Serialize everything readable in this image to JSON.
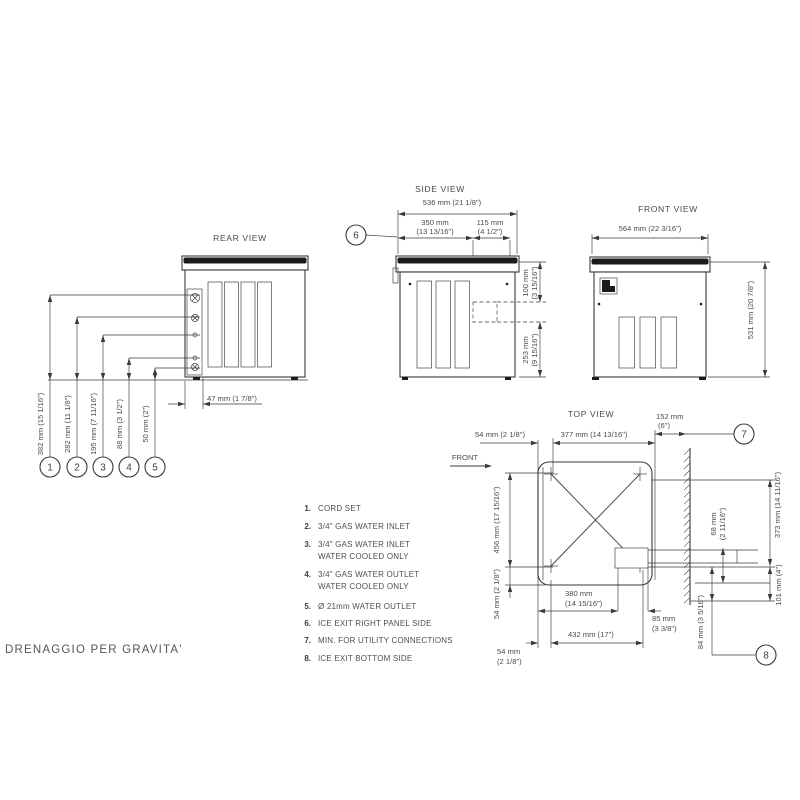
{
  "footer_note": "DRENAGGIO PER GRAVITA'",
  "views": {
    "rear": {
      "label": "REAR VIEW",
      "dim_382": "382 mm (15 1/16\")",
      "dim_282": "282 mm (11 1/8\")",
      "dim_195": "195 mm (7 11/16\")",
      "dim_88": "88 mm (3 1/2\")",
      "dim_50": "50 mm (2\")",
      "dim_47": "47 mm (1 7/8\")",
      "c1": "1",
      "c2": "2",
      "c3": "3",
      "c4": "4",
      "c5": "5"
    },
    "side": {
      "label": "SIDE VIEW",
      "dim_536": "536 mm (21 1/8\")",
      "dim_350_l1": "350 mm",
      "dim_350_l2": "(13 13/16\")",
      "dim_115_l1": "115 mm",
      "dim_115_l2": "(4 1/2\")",
      "dim_100_l1": "100 mm",
      "dim_100_l2": "(3 15/16\")",
      "dim_253_l1": "253 mm",
      "dim_253_l2": "(9 15/16\")",
      "c6": "6"
    },
    "front": {
      "label": "FRONT VIEW",
      "dim_564": "564 mm (22 3/16\")",
      "dim_531": "531 mm (20 7/8\")"
    },
    "top": {
      "label": "TOP VIEW",
      "front_label": "FRONT",
      "dim_54_top": "54 mm  (2 1/8\")",
      "dim_377": "377 mm  (14 13/16\")",
      "dim_152_l1": "152 mm",
      "dim_152_l2": "(6\")",
      "dim_456": "456 mm (17 15/16\")",
      "dim_54_left": "54 mm (2 1/8\")",
      "dim_380_l1": "380 mm",
      "dim_380_l2": "(14 15/16\")",
      "dim_432": "432 mm  (17\")",
      "dim_85_l1": "85 mm",
      "dim_85_l2": "(3 3/8\")",
      "dim_54_bot_l1": "54 mm",
      "dim_54_bot_l2": "(2 1/8\")",
      "dim_68_l1": "68 mm",
      "dim_68_l2": "(2 11/16\")",
      "dim_373": "373 mm (14 11/16\")",
      "dim_101": "101 mm (4\")",
      "dim_84": "84 mm (3 5/16\")",
      "c7": "7",
      "c8": "8"
    }
  },
  "legend": {
    "items": [
      {
        "num": "1.",
        "line1": "CORD SET"
      },
      {
        "num": "2.",
        "line1": "3/4\" GAS WATER INLET"
      },
      {
        "num": "3.",
        "line1": "3/4\" GAS WATER INLET",
        "line2": "WATER COOLED ONLY"
      },
      {
        "num": "4.",
        "line1": "3/4\" GAS WATER OUTLET",
        "line2": "WATER COOLED ONLY"
      },
      {
        "num": "5.",
        "line1": "Ø 21mm WATER OUTLET"
      },
      {
        "num": "6.",
        "line1": "ICE EXIT  RIGHT PANEL SIDE"
      },
      {
        "num": "7.",
        "line1": "MIN. FOR UTILITY CONNECTIONS"
      },
      {
        "num": "8.",
        "line1": "ICE EXIT  BOTTOM SIDE"
      }
    ]
  },
  "colors": {
    "line": "#3a3a40",
    "text": "#4b4b51",
    "dark": "#1b1b1e"
  }
}
